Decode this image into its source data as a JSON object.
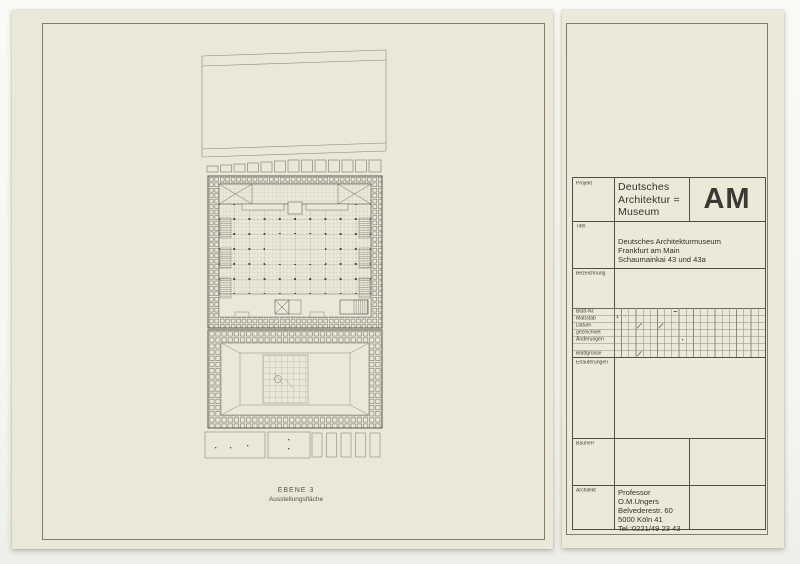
{
  "colors": {
    "paper": "#ebe8d9",
    "paper_right": "#ece9d8",
    "background": "#f6f6f2",
    "ink": "#33322d",
    "frame_line": "#817d6e",
    "plan_line": "#7d7a6e"
  },
  "drawing": {
    "caption_level": "EBENE 3",
    "caption_use": "Ausstellungsfläche"
  },
  "title_block": {
    "projekt": {
      "label": "Projekt",
      "lines": [
        "Deutsches",
        "Architektur =",
        "Museum"
      ],
      "logo": "AM"
    },
    "titel": {
      "label": "Titel",
      "lines": [
        "Deutsches Architekturmuseum",
        "Frankfurt am Main",
        "Schaumainkai  43 und 43a"
      ]
    },
    "bezeichnung": {
      "label": "Bezeichnung"
    },
    "grid": {
      "rows": [
        "Blatt-Nr.",
        "Maßstab",
        "Datum",
        "gezeichnet",
        "Änderungen",
        "",
        "Blattgrösse"
      ],
      "masstab_value": "1 :"
    },
    "erlaeuterungen": {
      "label": "Erläuterungen"
    },
    "bauherr": {
      "label": "Bauherr"
    },
    "architekt": {
      "label": "Architekt",
      "lines": [
        "Professor",
        "O.M.Ungers",
        "Belvederestr. 60",
        "5000  Köln 41",
        "Tel.:0221/49 23 43"
      ]
    }
  }
}
